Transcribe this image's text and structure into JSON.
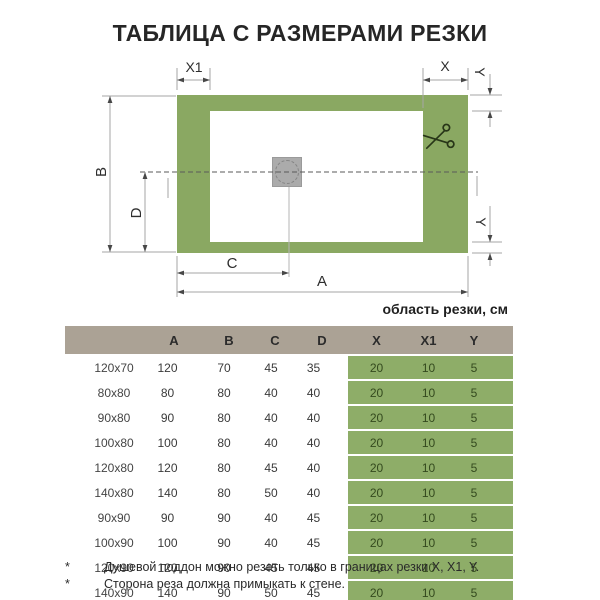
{
  "title": "ТАБЛИЦА С РАЗМЕРАМИ РЕЗКИ",
  "colors": {
    "tray_green": "#8aa862",
    "table_green": "#8ead68",
    "header_tan": "#aba295",
    "drain_gray": "#ababab",
    "dim_line": "#a6a6a6"
  },
  "diagram": {
    "labels": {
      "x1": "X1",
      "x": "X",
      "y_top": "Y",
      "b": "B",
      "d": "D",
      "c": "C",
      "a": "A",
      "y_bottom": "Y"
    }
  },
  "table": {
    "zone_label": "область резки, см",
    "columns": [
      "",
      "A",
      "B",
      "C",
      "D",
      "X",
      "X1",
      "Y"
    ],
    "rows": [
      {
        "size": "120x70",
        "a": "120",
        "b": "70",
        "c": "45",
        "d": "35",
        "x": "20",
        "x1": "10",
        "y": "5"
      },
      {
        "size": "80x80",
        "a": "80",
        "b": "80",
        "c": "40",
        "d": "40",
        "x": "20",
        "x1": "10",
        "y": "5"
      },
      {
        "size": "90x80",
        "a": "90",
        "b": "80",
        "c": "40",
        "d": "40",
        "x": "20",
        "x1": "10",
        "y": "5"
      },
      {
        "size": "100x80",
        "a": "100",
        "b": "80",
        "c": "40",
        "d": "40",
        "x": "20",
        "x1": "10",
        "y": "5"
      },
      {
        "size": "120x80",
        "a": "120",
        "b": "80",
        "c": "45",
        "d": "40",
        "x": "20",
        "x1": "10",
        "y": "5"
      },
      {
        "size": "140x80",
        "a": "140",
        "b": "80",
        "c": "50",
        "d": "40",
        "x": "20",
        "x1": "10",
        "y": "5"
      },
      {
        "size": "90x90",
        "a": "90",
        "b": "90",
        "c": "40",
        "d": "45",
        "x": "20",
        "x1": "10",
        "y": "5"
      },
      {
        "size": "100x90",
        "a": "100",
        "b": "90",
        "c": "40",
        "d": "45",
        "x": "20",
        "x1": "10",
        "y": "5"
      },
      {
        "size": "120x90",
        "a": "120",
        "b": "90",
        "c": "45",
        "d": "45",
        "x": "20",
        "x1": "10",
        "y": "5"
      },
      {
        "size": "140x90",
        "a": "140",
        "b": "90",
        "c": "50",
        "d": "45",
        "x": "20",
        "x1": "10",
        "y": "5"
      }
    ]
  },
  "footnotes": [
    {
      "marker": "*",
      "text": "Душевой поддон можно резать только в границах резки X, X1, Y."
    },
    {
      "marker": "*",
      "text": "Сторона реза должна примыкать к стене."
    }
  ]
}
